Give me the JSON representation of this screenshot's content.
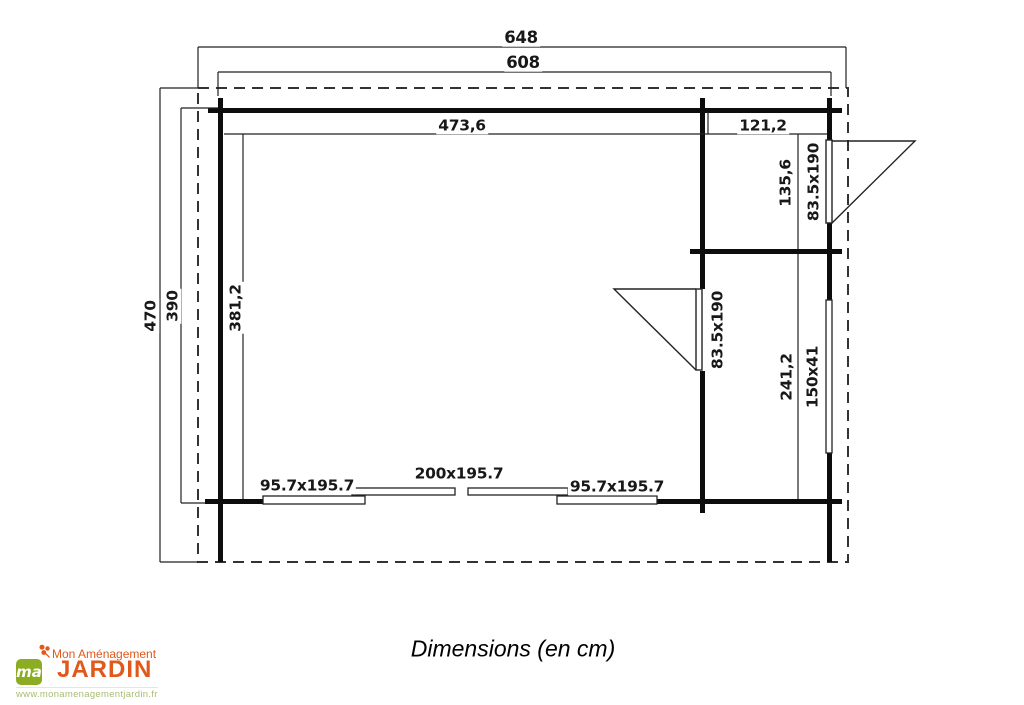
{
  "plan": {
    "dimensions": {
      "roof_width": "648",
      "exterior_width": "608",
      "main_room_width": "473,6",
      "annex_width": "121,2",
      "roof_depth": "470",
      "exterior_depth": "390",
      "main_room_depth": "381,2",
      "annex_top_depth": "135,6",
      "annex_bottom_depth": "241,2"
    },
    "openings": {
      "annex_door": "83.5x190",
      "interior_door": "83.5x190",
      "side_window": "150x41",
      "front_left_window": "95.7x195.7",
      "front_sliding_door": "200x195.7",
      "front_right_window": "95.7x195.7"
    },
    "line_color": "#1a1a1a"
  },
  "caption": "Dimensions (en cm)",
  "logo": {
    "tagline": "Mon Aménagement",
    "brand": "JARDIN",
    "monogram": "ma",
    "url": "www.monamenagementjardin.fr",
    "colors": {
      "orange": "#e0581a",
      "green": "#8cad21",
      "url_text": "#a9bc74"
    }
  }
}
